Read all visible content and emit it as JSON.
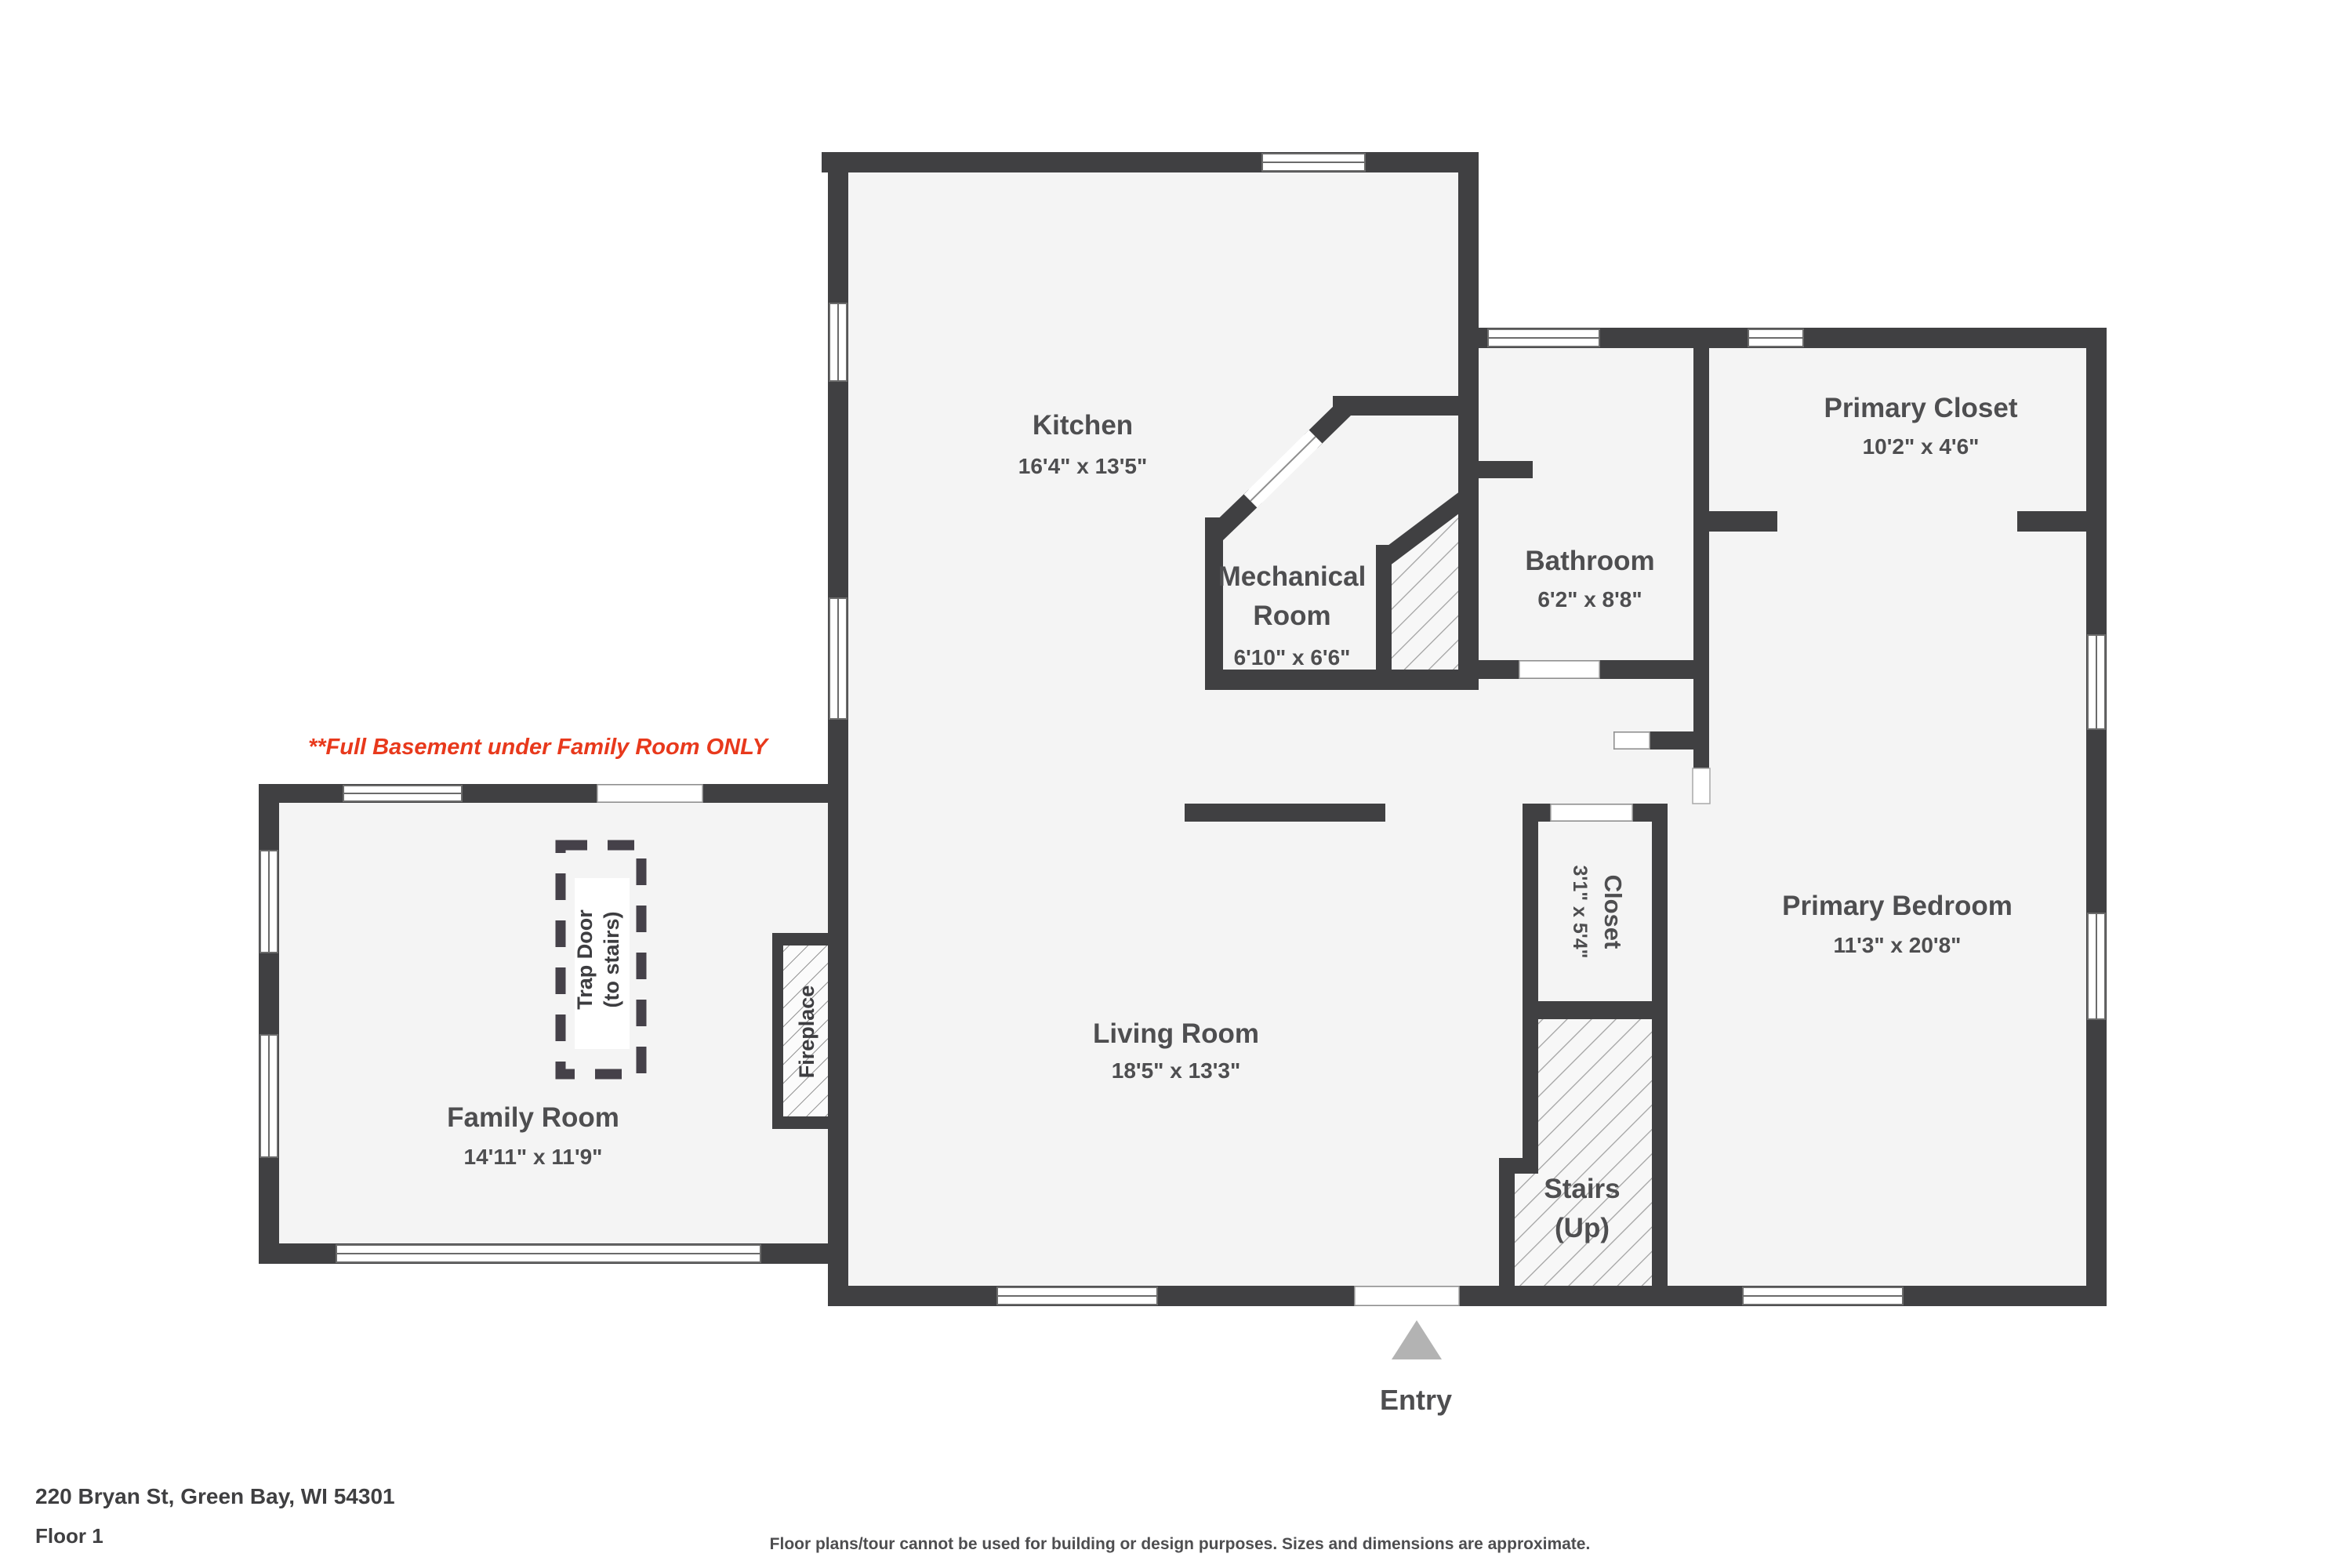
{
  "page": {
    "address": "220 Bryan St, Green Bay, WI 54301",
    "floor": "Floor 1",
    "disclaimer": "Floor plans/tour cannot be used for building or design purposes. Sizes and dimensions are approximate.",
    "basement_note": "**Full Basement under Family Room ONLY"
  },
  "rooms": {
    "kitchen": {
      "name": "Kitchen",
      "dims": "16'4\" x 13'5\""
    },
    "mechanical": {
      "name1": "Mechanical",
      "name2": "Room",
      "dims": "6'10\" x 6'6\""
    },
    "bathroom": {
      "name": "Bathroom",
      "dims": "6'2\" x 8'8\""
    },
    "primary_closet": {
      "name": "Primary Closet",
      "dims": "10'2\" x 4'6\""
    },
    "primary_bedroom": {
      "name": "Primary Bedroom",
      "dims": "11'3\" x 20'8\""
    },
    "living": {
      "name": "Living Room",
      "dims": "18'5\" x 13'3\""
    },
    "family": {
      "name": "Family Room",
      "dims": "14'11\" x 11'9\""
    },
    "closet": {
      "name": "Closet",
      "dims": "3'1\" x 5'4\""
    },
    "stairs": {
      "name1": "Stairs",
      "name2": "(Up)"
    },
    "trap_door": {
      "line1": "Trap Door",
      "line2": "(to stairs)"
    },
    "fireplace": {
      "name": "Fireplace"
    },
    "entry": {
      "name": "Entry"
    }
  },
  "colors": {
    "wall": "#404042",
    "room_fill": "#f4f4f4",
    "hatch_line": "#a0a0a0",
    "accent_red": "#e8391c",
    "label": "#4e4e50",
    "entry_arrow": "#b3b3b3"
  }
}
